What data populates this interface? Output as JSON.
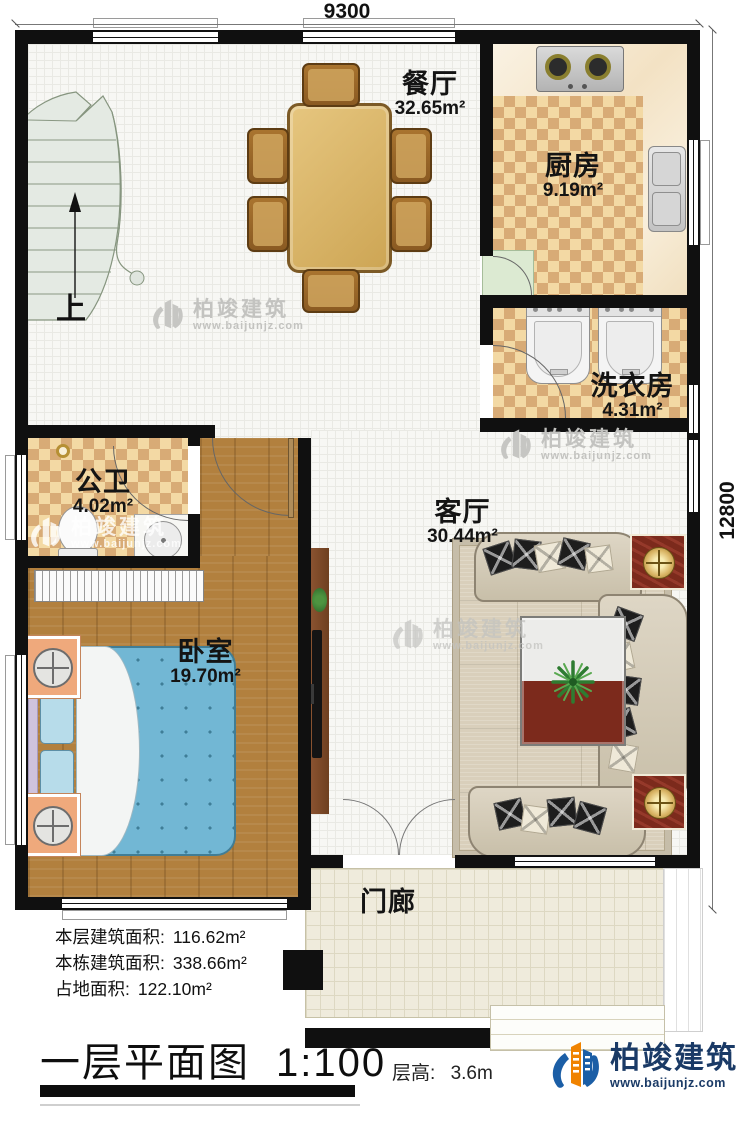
{
  "dimensions": {
    "top": "9300",
    "right": "12800"
  },
  "stairs": {
    "up_label": "上"
  },
  "rooms": {
    "dining": {
      "name": "餐厅",
      "area": "32.65m²"
    },
    "kitchen": {
      "name": "厨房",
      "area": "9.19m²"
    },
    "laundry": {
      "name": "洗衣房",
      "area": "4.31m²"
    },
    "bathroom": {
      "name": "公卫",
      "area": "4.02m²"
    },
    "living": {
      "name": "客厅",
      "area": "30.44m²"
    },
    "bedroom": {
      "name": "卧室",
      "area": "19.70m²"
    },
    "porch": {
      "name": "门廊"
    }
  },
  "stats": {
    "floor_area_label": "本层建筑面积:",
    "floor_area": "116.62m²",
    "building_area_label": "本栋建筑面积:",
    "building_area": "338.66m²",
    "footprint_label": "占地面积:",
    "footprint": "122.10m²"
  },
  "titleblock": {
    "title": "一层平面图",
    "scale": "1:100",
    "floor_height_label": "层高:",
    "floor_height_value": "3.6m"
  },
  "brand": {
    "name": "柏竣建筑",
    "website": "www.baijunjz.com"
  },
  "watermark": {
    "name": "柏竣建筑",
    "website": "www.baijunjz.com"
  },
  "colors": {
    "wall": "#101010",
    "brand_blue": "#1b5ea6",
    "brand_orange": "#f08300",
    "brand_navy": "#1a3a66"
  }
}
